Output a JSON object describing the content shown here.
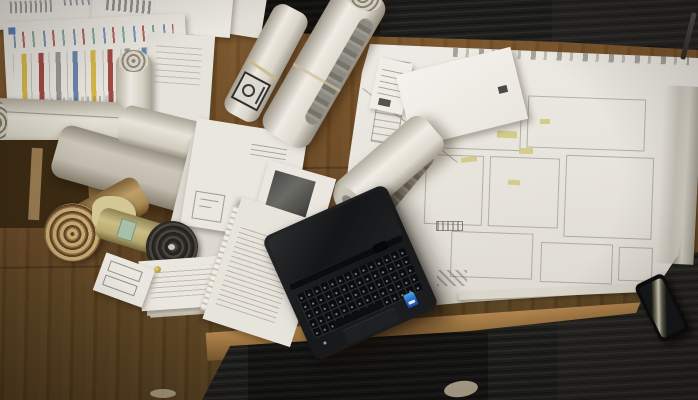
{
  "scene": {
    "description": "Top-down photograph of a wooden architect desk: a large architectural floor-plan blueprint on the right with a white envelope and a rolled paper tube lying on it, an open black laptop with a blue brand sticker in the lower centre extending over the desk edge onto dark carpet, a cluster of rolled-up drawings and plan tubes on the left beside a paper with colorful vertical chart stripes, loose white paper stacks along the top-left, a smartphone with a bright screen reflection on the carpet at lower right, and a pen at the top-right corner. Dark striated carpet bands run along the top and bottom edges of the warm brown desk.",
    "caption_label": "Architect desk with blueprints, plan rolls and laptop (photo recreation)",
    "colors": {
      "desk_wood": "#6e4c25",
      "desk_edge_highlight": "#b3854f",
      "carpet": "#1f1f1e",
      "blueprint_paper": "#e8e5de",
      "highlight_marks": "#cfc87e",
      "chart_stripe_yellow": "#d6b84a",
      "chart_stripe_red": "#a14a44",
      "chart_stripe_gray": "#9a9894",
      "chart_stripe_blue": "#6a86ac",
      "laptop_body": "#17181a",
      "brand_sticker_blue": "#1f5fc0",
      "kraft_roll": "#bd9f68",
      "cardboard_box": "#9a7c52"
    },
    "objects": [
      "blueprint-floor-plan",
      "envelope",
      "paper-tube-roll",
      "laptop-with-keyboard-and-touchpad",
      "brand-sticker",
      "rolled-plan-with-title-label",
      "large-white-plan-roll",
      "kraft-spiral-roll",
      "dark-spiral-roll",
      "yellow-roll-with-label",
      "cardboard-box",
      "chart-stripe-sheet",
      "paper-stacks",
      "smartphone",
      "pen"
    ]
  }
}
